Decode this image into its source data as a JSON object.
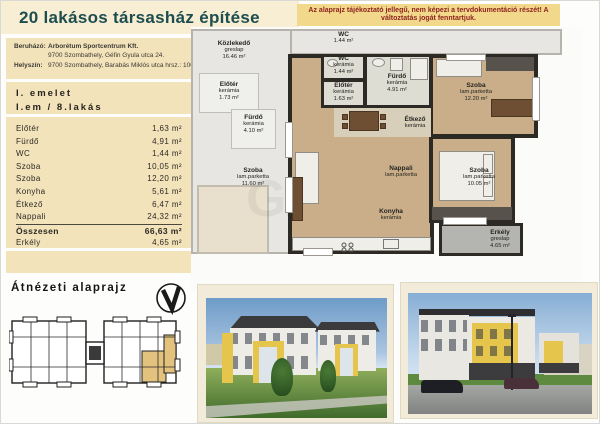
{
  "header": {
    "title": "20 lakásos társasház építése",
    "disclaimer": "Az alaprajz tájékoztató jellegű, nem képezi a tervdokumentáció részét! A változtatás jogát fenntartjuk."
  },
  "project": {
    "developer_label": "Beruházó:",
    "developer_name": "Arborétum Sportcentrum Kft.",
    "developer_address": "9700 Szombathely, Géfin Gyula utca 24.",
    "site_label": "Helyszín:",
    "site_address": "9700 Szombathely, Barabás Miklós utca hrsz.: 1006/7."
  },
  "unit": {
    "floor": "I. emelet",
    "designation": "I.em /   8.lakás"
  },
  "areas": {
    "rows": [
      {
        "label": "Előtér",
        "value": "1,63 m²"
      },
      {
        "label": "Fürdő",
        "value": "4,91 m²"
      },
      {
        "label": "WC",
        "value": "1,44 m²"
      },
      {
        "label": "Szoba",
        "value": "10,05 m²"
      },
      {
        "label": "Szoba",
        "value": "12,20 m²"
      },
      {
        "label": "Konyha",
        "value": "5,61 m²"
      },
      {
        "label": "Étkező",
        "value": "6,47 m²"
      },
      {
        "label": "Nappali",
        "value": "24,32 m²"
      }
    ],
    "total_label": "Összesen",
    "total_value": "66,63 m²",
    "balcony_label": "Erkély",
    "balcony_value": "4,65 m²"
  },
  "overview": {
    "title": "Átnézeti alaprajz"
  },
  "floorplan": {
    "watermark": "GDN",
    "rooms": {
      "wc": {
        "name": "WC",
        "material": "kerámia",
        "area": "1.44 m²"
      },
      "eloter": {
        "name": "Előtér",
        "material": "kerámia",
        "area": "1.63 m²"
      },
      "furdo": {
        "name": "Fürdő",
        "material": "kerámia",
        "area": "4.91 m²"
      },
      "szoba_top": {
        "name": "Szoba",
        "material": "lam.parketta",
        "area": "12.20 m²"
      },
      "etkezo": {
        "name": "Étkező",
        "material": "kerámia",
        "area": ""
      },
      "nappali": {
        "name": "Nappali",
        "material": "lam.parketta",
        "area": ""
      },
      "konyha": {
        "name": "Konyha",
        "material": "kerámia",
        "area": ""
      },
      "szoba_bottom": {
        "name": "Szoba",
        "material": "lam.parketta",
        "area": "10.05 m²"
      },
      "erkely": {
        "name": "Erkély",
        "material": "greslap",
        "area": "4.65 m²"
      }
    },
    "neighbors": {
      "kozlekedo": {
        "name": "Közlekedő",
        "material": "greslap",
        "area": "16.46 m²"
      },
      "wc2": {
        "name": "WC",
        "material": "kerámia",
        "area": "1.44 m²"
      },
      "eloter2": {
        "name": "Előtér",
        "material": "kerámia",
        "area": "1.73 m²"
      },
      "furdo2": {
        "name": "Fürdő",
        "material": "kerámia",
        "area": "4.10 m²"
      },
      "szoba3": {
        "name": "Szoba",
        "material": "lam.parketta",
        "area": "11.60 m²"
      }
    }
  },
  "colors": {
    "header_beige": "#f7eed3",
    "panel_beige": "#f3e3ba",
    "band_yellow": "#f2d88a",
    "title_teal": "#1d4d4f",
    "disclaimer_red": "#8e2320",
    "wall_dark": "#2d2a26",
    "floor_wood": "#c9ae89",
    "floor_ceramic": "#deddd3",
    "highlight_yellow": "#e3c27d"
  }
}
